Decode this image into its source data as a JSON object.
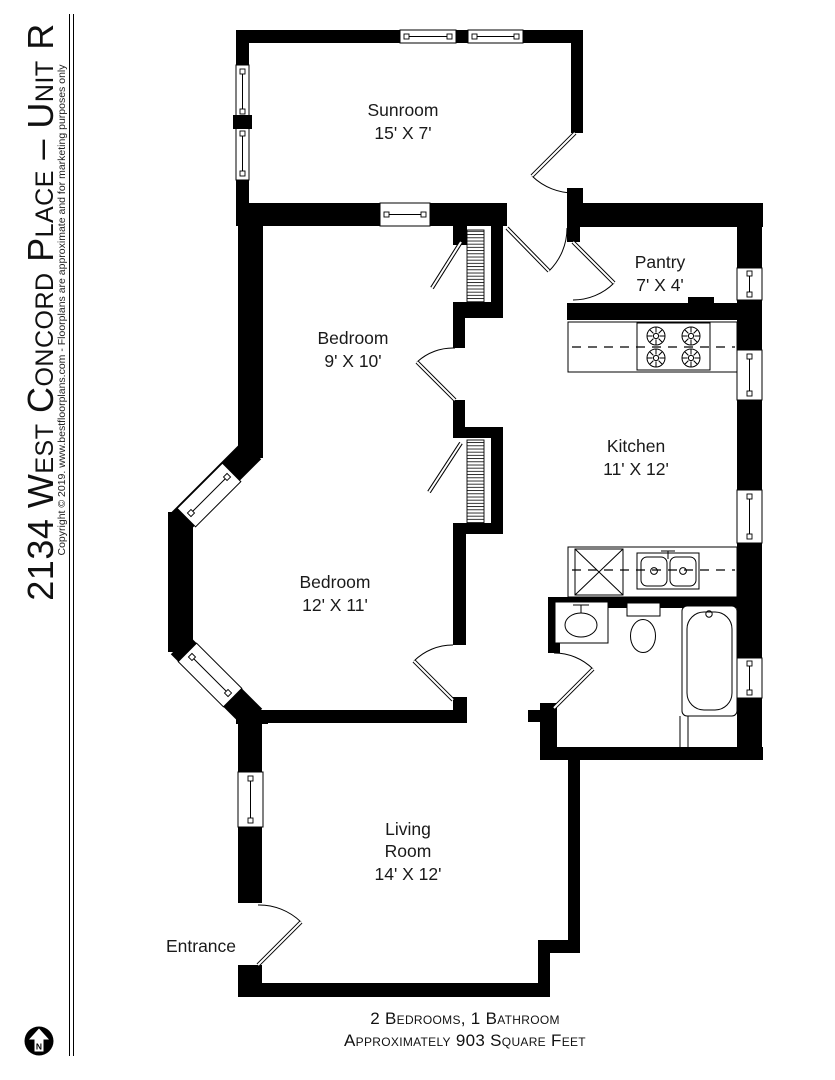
{
  "sidebar": {
    "title": "2134 West Concord Place – Unit R",
    "copyright": "Copyright © 2019. www.bestfloorplans.com - Floorplans are approximate and for marketing purposes only"
  },
  "plan": {
    "rooms": {
      "sunroom": {
        "name": "Sunroom",
        "dims": "15' X 7'"
      },
      "bedroom1": {
        "name": "Bedroom",
        "dims": "9' X 10'"
      },
      "pantry": {
        "name": "Pantry",
        "dims": "7' X 4'"
      },
      "kitchen": {
        "name": "Kitchen",
        "dims": "11' X 12'"
      },
      "bedroom2": {
        "name": "Bedroom",
        "dims": "12' X 11'"
      },
      "living_room": {
        "line1": "Living",
        "line2": "Room",
        "dims": "14' X 12'"
      },
      "entrance": {
        "name": "Entrance"
      }
    },
    "north_label": "N",
    "wall_color": "#000000",
    "background_color": "#ffffff"
  },
  "footer": {
    "line1": "2 Bedrooms, 1 Bathroom",
    "line2": "Approximately 903 Square Feet"
  }
}
